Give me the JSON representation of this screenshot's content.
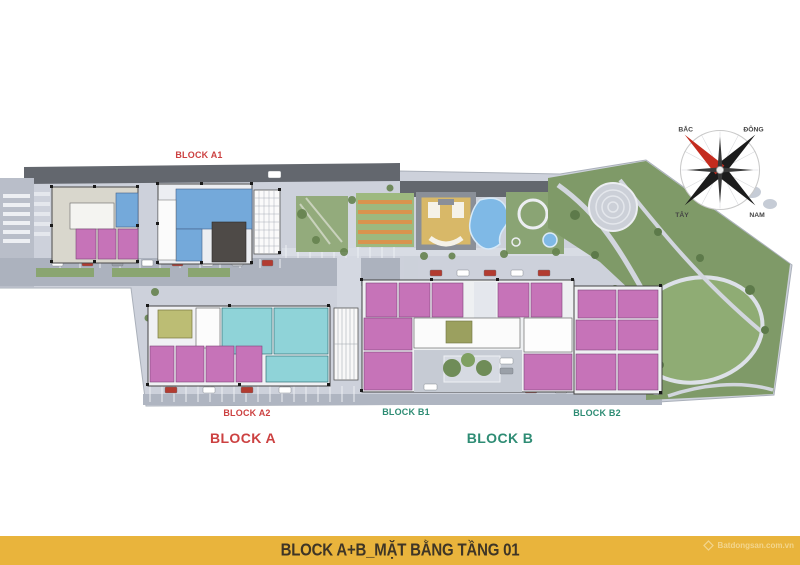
{
  "page": {
    "type": "architectural-site-plan-rendering"
  },
  "labels": {
    "block_a1": "BLOCK A1",
    "block_a2": "BLOCK A2",
    "block_b1": "BLOCK B1",
    "block_b2": "BLOCK B2",
    "block_a": "BLOCK A",
    "block_b": "BLOCK B"
  },
  "compass": {
    "north": "BẮC",
    "east": "ĐÔNG",
    "west": "TÂY",
    "south": "NAM"
  },
  "footer": {
    "title": "BLOCK A+B_MẶT BẰNG TẦNG 01",
    "watermark": "Batdongsan.com.vn"
  },
  "colors": {
    "footer_bg": "#E9B43C",
    "label_red": "#CC4141",
    "label_teal": "#2E8C74",
    "unit_pink": "#C673B8",
    "unit_cyan": "#8FD3D8",
    "unit_blue": "#74A9DA",
    "unit_olive": "#BCBD74",
    "park_green": "#7F9A68",
    "pool_blue": "#7FB9E6",
    "road_dark": "#63676E",
    "pavement": "#CDD1DB",
    "compass_needle_red": "#C42B1E"
  }
}
